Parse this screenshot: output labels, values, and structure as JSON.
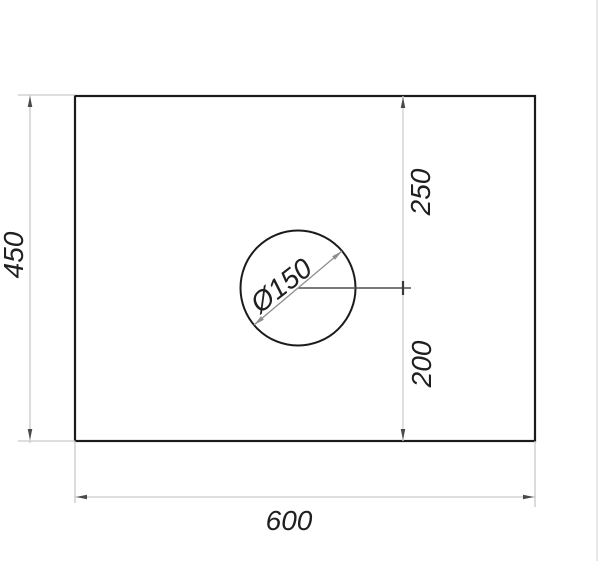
{
  "drawing": {
    "type": "technical-drawing",
    "part": {
      "shape": "rectangular plate with circular hole",
      "width_mm": 600,
      "height_mm": 450,
      "hole_diameter_mm": 150,
      "hole_center_from_top_mm": 250,
      "hole_center_from_bottom_mm": 200
    },
    "labels": {
      "height": "450",
      "width": "600",
      "offset_top": "250",
      "offset_bottom": "200",
      "diameter": "Ø150"
    },
    "colors": {
      "background": "#ffffff",
      "object_line": "#1b1b1b",
      "dimension_line": "#c9c9c9",
      "extension_line": "#c9c9c9",
      "arrow": "#4a4a4a",
      "diameter_line": "#8f8f8f",
      "centerline": "#4f4f4f",
      "text": "#1f1f1f",
      "page_edge": "#e8e8e8"
    }
  }
}
